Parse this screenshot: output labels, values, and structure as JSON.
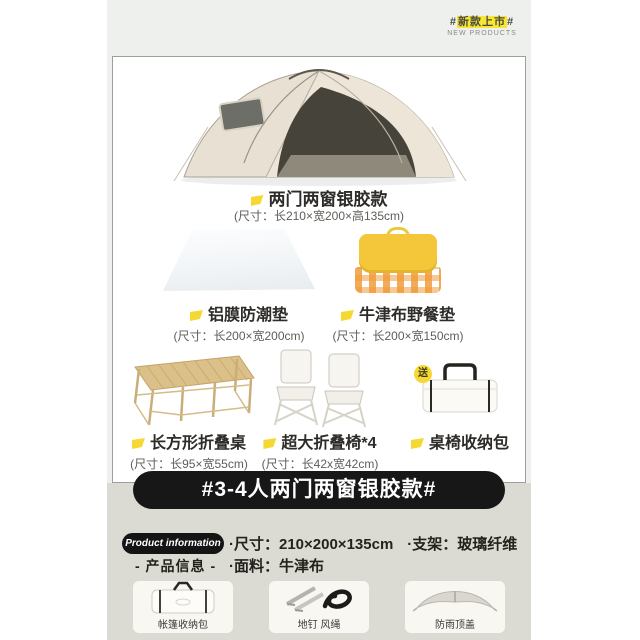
{
  "colors": {
    "accent_yellow": "#f5d832",
    "highlight_yellow": "#f7e733",
    "banner_black": "#171717",
    "panel_gray": "#eef0ee",
    "bottom_beige": "#dcdbd3"
  },
  "new_badge": {
    "hash_left": "#",
    "title": "新款上市",
    "hash_right": "#",
    "subtitle": "NEW PRODUCTS"
  },
  "bundle": {
    "tent": {
      "label": "两门两窗银胶款",
      "size": "(尺寸：长210×宽200×高135cm)"
    },
    "items": [
      {
        "label": "铝膜防潮垫",
        "size": "(尺寸：长200×宽200cm)"
      },
      {
        "label": "牛津布野餐垫",
        "size": "(尺寸：长200×宽150cm)"
      },
      {
        "label": "长方形折叠桌",
        "size": "(尺寸：长95×宽55cm)"
      },
      {
        "label": "超大折叠椅*4",
        "size": "(尺寸：长42x宽42cm)"
      },
      {
        "label": "桌椅收纳包",
        "gift_badge": "送"
      }
    ]
  },
  "banner": {
    "text": "#3-4人两门两窗银胶款#"
  },
  "product_info": {
    "pill": "Product information",
    "heading_cn": "- 产品信息 -",
    "spec_size": "·尺寸：210×200×135cm",
    "spec_frame": "·支架：玻璃纤维",
    "spec_fabric": "·面料：牛津布"
  },
  "accessories": [
    {
      "label": "帐篷收纳包"
    },
    {
      "label": "地钉 风绳"
    },
    {
      "label": "防雨顶盖"
    }
  ]
}
